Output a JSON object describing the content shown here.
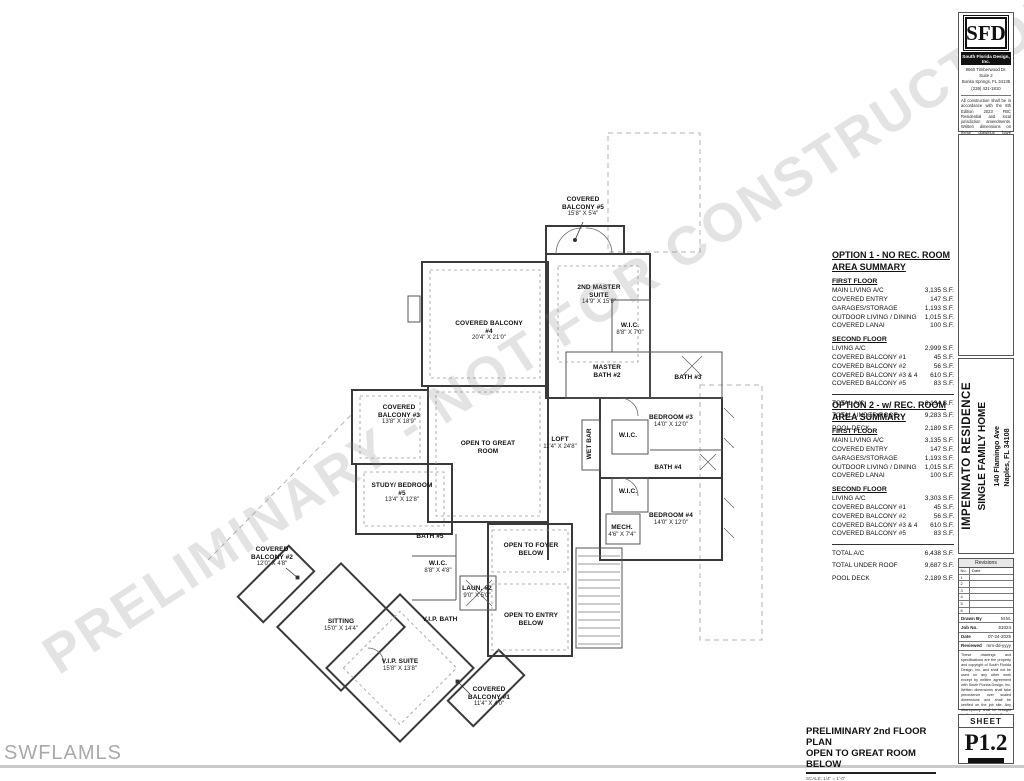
{
  "watermarks": {
    "diagonal": "PRELIMINARY - NOT FOR CONSTRUCTION",
    "corner": "SWFLAMLS"
  },
  "title_block": {
    "logo_text": "SFD",
    "company": "South Florida Design, Inc.",
    "address_lines": [
      "9660 Timberwood Dr.",
      "Suite 2",
      "Bonita Springs, FL 34135",
      "(239) 431-1810"
    ],
    "disclaimer": "All construction shall be in accordance with the 8th Edition 2023 FBC Residential and local jurisdiction amendments. Written dimensions on these drawings have precedence over scale dimensions. Contractors shall verify and be responsible for all dimensions and conditions on the job. SFD shall be notified in writing of any variations or discrepancies from the dimensions, conditions and specifications shown by these drawings.",
    "project_lines": [
      "IMPENNATO RESIDENCE",
      "SINGLE FAMILY HOME",
      "140 Flamingo Ave",
      "Naples, FL  34108"
    ],
    "revisions": {
      "title": "Revisions",
      "col_no": "No.",
      "col_date": "Date",
      "rows": [
        "1",
        "2",
        "3",
        "4",
        "5",
        "6"
      ]
    },
    "meta": [
      {
        "label": "Drawn By",
        "value": "M.M."
      },
      {
        "label": "Job No.",
        "value": "61024"
      },
      {
        "label": "Date",
        "value": "07-24-2025"
      },
      {
        "label": "Reviewed",
        "value": "mm-dd-yyyy"
      }
    ],
    "copyright": "These drawings and specifications are the property and copyright of South Florida Design, Inc. and shall not be used on any other work except by written agreement with South Florida Design, Inc. Written dimensions shall take precedence over scaled dimensions and shall be verified on the job site. Any discrepancy shall be brought to the notice of South Florida Design, Inc. prior to the commencement of any work.",
    "sheet_label": "SHEET",
    "sheet_number": "P1.2"
  },
  "summaries": [
    {
      "title_line1": "OPTION 1 - NO REC. ROOM",
      "title_line2": "AREA SUMMARY",
      "sections": [
        {
          "header": "FIRST FLOOR",
          "rows": [
            [
              "MAIN LIVING A/C",
              "3,135 S.F."
            ],
            [
              "COVERED ENTRY",
              "147 S.F."
            ],
            [
              "GARAGES/STORAGE",
              "1,193 S.F."
            ],
            [
              "OUTDOOR LIVING / DINING",
              "1,015 S.F."
            ],
            [
              "COVERED LANAI",
              "100 S.F."
            ]
          ]
        },
        {
          "header": "SECOND FLOOR",
          "rows": [
            [
              "LIVING A/C",
              "2,999 S.F."
            ],
            [
              "COVERED BALCONY #1",
              "45 S.F."
            ],
            [
              "COVERED BALCONY #2",
              "56 S.F."
            ],
            [
              "COVERED BALCONY #3 & 4",
              "610 S.F."
            ],
            [
              "COVERED BALCONY #5",
              "83 S.F."
            ]
          ]
        }
      ],
      "totals": [
        [
          "TOTAL A/C",
          "6,134 S.F."
        ],
        [
          "TOTAL UNDER ROOF",
          "9,283 S.F."
        ],
        [
          "POOL DECK",
          "2,189 S.F."
        ]
      ]
    },
    {
      "title_line1": "OPTION 2 - w/ REC. ROOM",
      "title_line2": "AREA SUMMARY",
      "sections": [
        {
          "header": "FIRST FLOOR",
          "rows": [
            [
              "MAIN LIVING A/C",
              "3,135 S.F."
            ],
            [
              "COVERED ENTRY",
              "147 S.F."
            ],
            [
              "GARAGES/STORAGE",
              "1,193 S.F."
            ],
            [
              "OUTDOOR LIVING / DINING",
              "1,015 S.F."
            ],
            [
              "COVERED LANAI",
              "100 S.F."
            ]
          ]
        },
        {
          "header": "SECOND FLOOR",
          "rows": [
            [
              "LIVING A/C",
              "3,303 S.F."
            ],
            [
              "COVERED BALCONY #1",
              "45 S.F."
            ],
            [
              "COVERED BALCONY #2",
              "56 S.F."
            ],
            [
              "COVERED BALCONY #3 & 4",
              "610 S.F."
            ],
            [
              "COVERED BALCONY #5",
              "83 S.F."
            ]
          ]
        }
      ],
      "totals": [
        [
          "TOTAL A/C",
          "6,438 S.F."
        ],
        [
          "TOTAL UNDER ROOF",
          "9,687 S.F."
        ],
        [
          "POOL DECK",
          "2,189 S.F."
        ]
      ]
    }
  ],
  "plan_title": {
    "line1": "PRELIMINARY 2nd FLOOR PLAN",
    "line2": "OPEN TO GREAT ROOM BELOW",
    "scale": "SCALE: 1/4\" = 1'-0\""
  },
  "plan": {
    "rooms": [
      {
        "id": "covered-balcony-5",
        "name": "COVERED BALCONY #5",
        "dims": "15'8\" X 5'4\"",
        "cx": 583,
        "y": 196,
        "w": 62
      },
      {
        "id": "second-master-suite",
        "name": "2ND MASTER SUITE",
        "dims": "14'9\" X 15'9\"",
        "cx": 599,
        "y": 284,
        "w": 64
      },
      {
        "id": "covered-balcony-4",
        "name": "COVERED BALCONY #4",
        "dims": "20'4\" X 21'0\"",
        "cx": 489,
        "y": 320,
        "w": 72
      },
      {
        "id": "covered-balcony-3",
        "name": "COVERED BALCONY #3",
        "dims": "13'8\" X 18'9\"",
        "cx": 399,
        "y": 404,
        "w": 66
      },
      {
        "id": "open-to-great-room",
        "name": "OPEN TO GREAT ROOM",
        "dims": "",
        "cx": 488,
        "y": 440,
        "w": 58
      },
      {
        "id": "study-bedroom-5",
        "name": "STUDY/ BEDROOM #5",
        "dims": "13'4\" X 12'8\"",
        "cx": 402,
        "y": 482,
        "w": 68
      },
      {
        "id": "loft",
        "name": "LOFT",
        "dims": "11'4\" X 24'8\"",
        "cx": 560,
        "y": 436,
        "w": 46
      },
      {
        "id": "bedroom-3",
        "name": "BEDROOM #3",
        "dims": "14'0\" X 12'0\"",
        "cx": 671,
        "y": 414,
        "w": 82
      },
      {
        "id": "bedroom-4",
        "name": "BEDROOM #4",
        "dims": "14'0\" X 12'0\"",
        "cx": 671,
        "y": 512,
        "w": 82
      },
      {
        "id": "master-bath-2",
        "name": "MASTER BATH #2",
        "dims": "",
        "cx": 607,
        "y": 364,
        "w": 44
      },
      {
        "id": "bath-3",
        "name": "BATH #3",
        "dims": "",
        "cx": 688,
        "y": 374,
        "w": 40
      },
      {
        "id": "bath-4",
        "name": "BATH #4",
        "dims": "",
        "cx": 668,
        "y": 464,
        "w": 40
      },
      {
        "id": "wic-master",
        "name": "W.I.C.",
        "dims": "8'8\" X 7'0\"",
        "cx": 630,
        "y": 322,
        "w": 40
      },
      {
        "id": "wic-bedroom-3",
        "name": "W.I.C.",
        "dims": "",
        "cx": 628,
        "y": 432,
        "w": 36
      },
      {
        "id": "wic-bedroom-4",
        "name": "W.I.C.",
        "dims": "",
        "cx": 628,
        "y": 488,
        "w": 36
      },
      {
        "id": "wet-bar",
        "name": "WET BAR",
        "dims": "",
        "cx": 590,
        "y": 440,
        "w": 34,
        "rot": -90
      },
      {
        "id": "mech",
        "name": "MECH.",
        "dims": "4'6\" X 7'4\"",
        "cx": 622,
        "y": 524,
        "w": 40
      },
      {
        "id": "open-to-foyer-below",
        "name": "OPEN TO FOYER BELOW",
        "dims": "",
        "cx": 531,
        "y": 542,
        "w": 58
      },
      {
        "id": "open-to-entry-below",
        "name": "OPEN TO ENTRY BELOW",
        "dims": "",
        "cx": 531,
        "y": 612,
        "w": 58
      },
      {
        "id": "laun-2",
        "name": "LAUN. #2",
        "dims": "9'0\" X 5'0\"",
        "cx": 477,
        "y": 585,
        "w": 42
      },
      {
        "id": "vip-bath",
        "name": "V.I.P. BATH",
        "dims": "",
        "cx": 440,
        "y": 616,
        "w": 36
      },
      {
        "id": "bath-5",
        "name": "BATH #5",
        "dims": "",
        "cx": 430,
        "y": 533,
        "w": 40
      },
      {
        "id": "wic-vip",
        "name": "W.I.C.",
        "dims": "8'8\" X 4'8\"",
        "cx": 438,
        "y": 560,
        "w": 40
      },
      {
        "id": "sitting",
        "name": "SITTING",
        "dims": "15'0\" X 14'4\"",
        "cx": 341,
        "y": 618,
        "w": 72
      },
      {
        "id": "vip-suite",
        "name": "V.I.P. SUITE",
        "dims": "15'8\" X 13'8\"",
        "cx": 400,
        "y": 658,
        "w": 72
      },
      {
        "id": "covered-balcony-2",
        "name": "COVERED BALCONY #2",
        "dims": "12'0\" X 4'8\"",
        "cx": 272,
        "y": 546,
        "w": 66
      },
      {
        "id": "covered-balcony-1",
        "name": "COVERED BALCONY #1",
        "dims": "11'4\" X 4'0\"",
        "cx": 489,
        "y": 686,
        "w": 66
      }
    ]
  }
}
